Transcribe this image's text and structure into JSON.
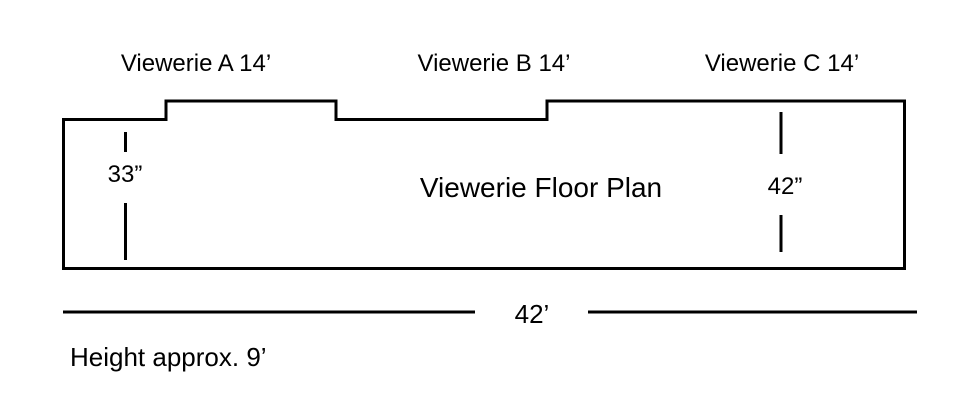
{
  "diagram": {
    "title": "Viewerie Floor Plan",
    "sections": [
      {
        "label": "Viewerie A 14’"
      },
      {
        "label": "Viewerie B 14’"
      },
      {
        "label": "Viewerie C 14’"
      }
    ],
    "dimensions": {
      "left_depth": "33”",
      "right_depth": "42”",
      "total_width": "42’",
      "height_note": "Height approx. 9’"
    },
    "colors": {
      "line": "#000000",
      "text": "#000000",
      "background": "#ffffff"
    }
  }
}
